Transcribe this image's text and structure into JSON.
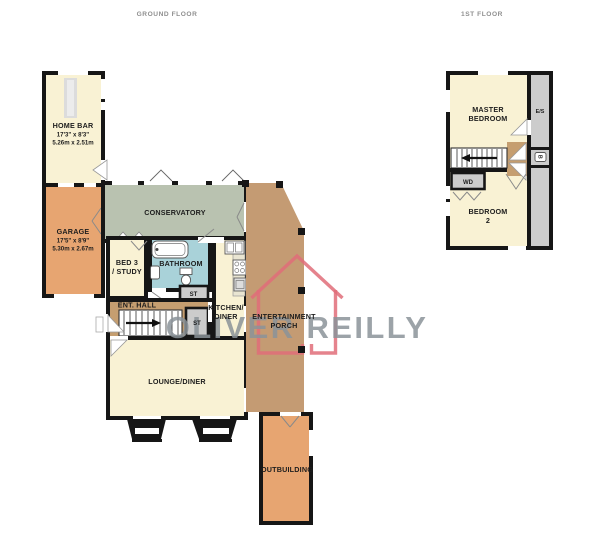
{
  "titles": {
    "ground": "GROUND FLOOR",
    "first": "1ST FLOOR"
  },
  "watermark": {
    "brand": "OLIVER REILLY"
  },
  "colors": {
    "wall": "#161616",
    "cream": "#f9f2d4",
    "orange": "#e7a571",
    "hall_tan": "#c59e70",
    "porch_tan": "#c49b73",
    "conservatory": "#b9c2b0",
    "bathroom": "#a9d2d9",
    "unit_gray": "#cccccc",
    "counter": "#e9e5d2",
    "bar_counter": "#dcdcdc",
    "watermark_pink": "#e06d79",
    "watermark_gray": "#8b9399"
  },
  "rooms": {
    "home_bar": {
      "name": "HOME BAR",
      "dims_ft": "17'3\" x 8'3\"",
      "dims_m": "5.26m x 2.51m"
    },
    "garage": {
      "name": "GARAGE",
      "dims_ft": "17'5\" x 8'9\"",
      "dims_m": "5.30m x 2.67m"
    },
    "conservatory": {
      "name": "CONSERVATORY"
    },
    "bed3": {
      "line1": "BED 3",
      "line2": "/ STUDY"
    },
    "bathroom": {
      "name": "BATHROOM"
    },
    "st_bathroom": {
      "name": "ST"
    },
    "ent_hall": {
      "name": "ENT. HALL"
    },
    "st_hall": {
      "name": "ST"
    },
    "kitchen": {
      "line1": "KITCHEN/",
      "line2": "DINER"
    },
    "lounge": {
      "name": "LOUNGE/DINER"
    },
    "porch": {
      "line1": "ENTERTAINMENT",
      "line2": "PORCH"
    },
    "outbuilding": {
      "name": "OUTBUILDING"
    },
    "master": {
      "line1": "MASTER",
      "line2": "BEDROOM"
    },
    "es": {
      "name": "E/S"
    },
    "boiler": {
      "name": "B"
    },
    "wd": {
      "name": "WD"
    },
    "bed2": {
      "line1": "BEDROOM",
      "line2": "2"
    }
  }
}
